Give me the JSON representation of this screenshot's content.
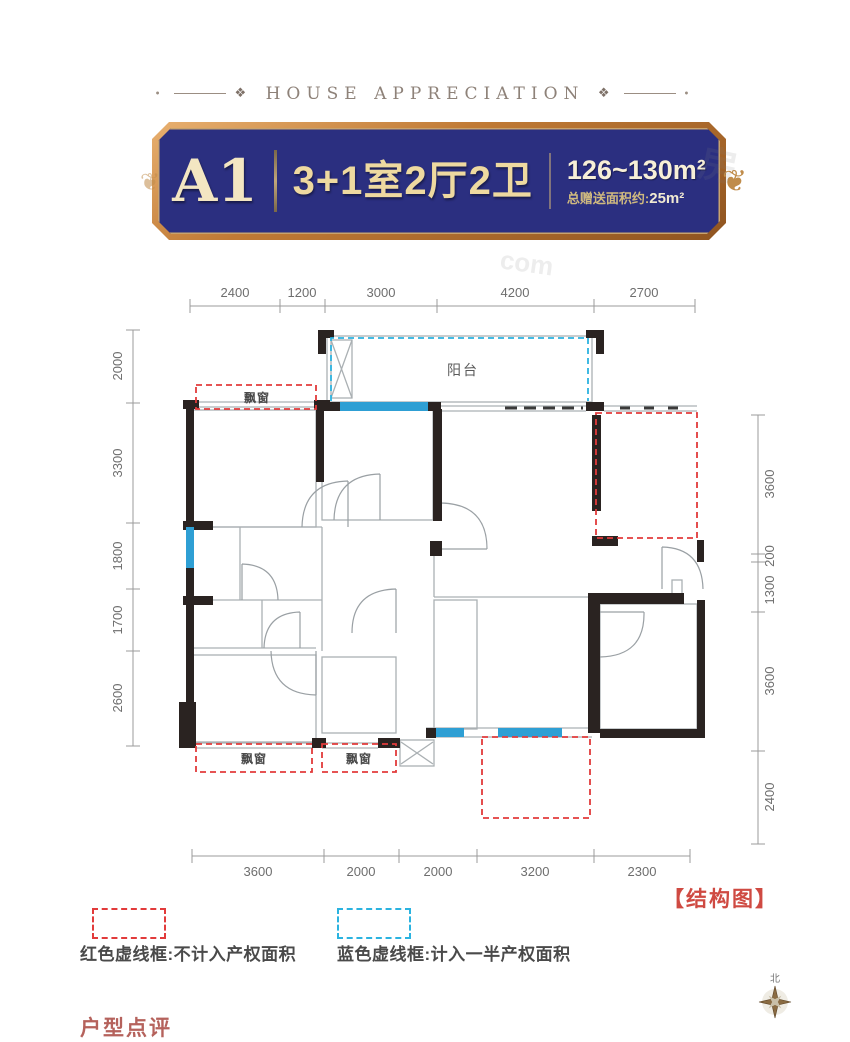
{
  "header": {
    "title": "HOUSE APPRECIATION",
    "ornament": "❖",
    "dot": "•"
  },
  "banner": {
    "unit": "A1",
    "layout": "3+1室2厅2卫",
    "area": "126~130m²",
    "bonus_label": "总赠送面积约:",
    "bonus_value": "25m²",
    "ornament": "❦",
    "colors": {
      "bg": "#2b2f80",
      "border": "#c07a35",
      "gold": "#eed9a0"
    }
  },
  "plan": {
    "dimensions": {
      "top": [
        "2400",
        "1200",
        "3000",
        "4200",
        "2700"
      ],
      "left": [
        "2000",
        "3300",
        "1800",
        "1700",
        "2600"
      ],
      "right": [
        "3600",
        "200",
        "1300",
        "3600",
        "2400"
      ],
      "bottom": [
        "3600",
        "2000",
        "2000",
        "3200",
        "2300"
      ]
    },
    "labels": {
      "balcony": "阳台",
      "bay_window": "飘窗"
    },
    "colors": {
      "wall": "#2a2321",
      "red_dash": "#e23b3b",
      "blue_dash": "#2bb3e0",
      "window_blue": "#2e9fd4",
      "thin_line": "#aab0b3",
      "dim_text": "#6e6e6e"
    }
  },
  "legend": {
    "red": "红色虚线框:不计入产权面积",
    "blue": "蓝色虚线框:计入一半产权面积"
  },
  "structure_label": "【结构图】",
  "compass": {
    "north": "北"
  },
  "watermarks": {
    "w1": "房",
    "w2": "com"
  },
  "footer_partial": "户型点评"
}
